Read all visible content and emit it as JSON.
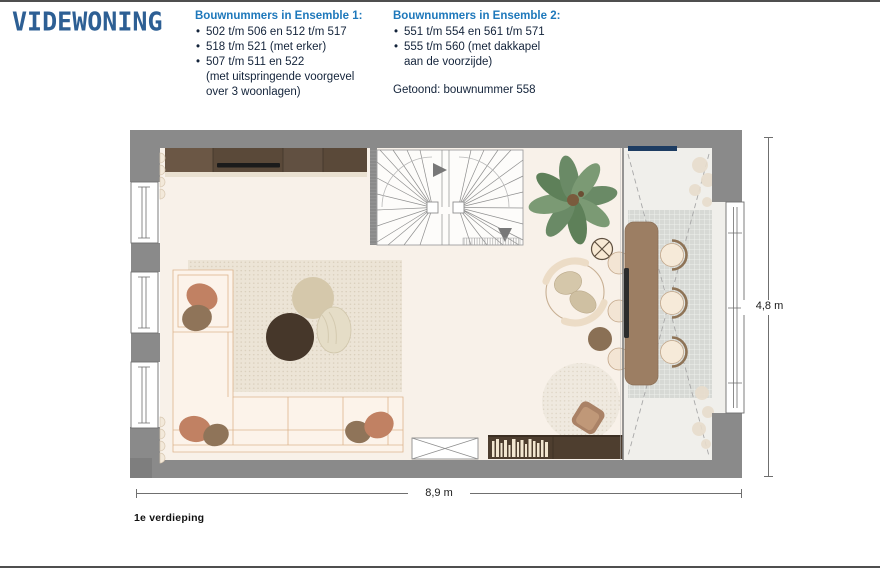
{
  "brand": {
    "logo_text": "VIDEWONING"
  },
  "header": {
    "ensemble1": {
      "title": "Bouwnummers in Ensemble 1:",
      "items": [
        "502 t/m 506 en 512 t/m 517",
        "518 t/m 521 (met erker)",
        "507 t/m 511 en 522\n(met uitspringende voorgevel\nover 3 woonlagen)"
      ]
    },
    "ensemble2": {
      "title": "Bouwnummers in Ensemble 2:",
      "items": [
        "551 t/m 554 en 561 t/m 571",
        "555 t/m 560 (met dakkapel\naan de voorzijde)"
      ],
      "shown_note": "Getoond: bouwnummer 558"
    }
  },
  "floorplan": {
    "floor_label": "1e verdieping",
    "dimensions": {
      "width_label": "8,9 m",
      "height_label": "4,8 m"
    },
    "depicted_elements": [
      "exterior-walls",
      "left-facade-windows",
      "right-facade-window",
      "winder-staircase",
      "wardrobe-cabinets",
      "corner-sofa",
      "area-rug",
      "poufs",
      "potted-plant",
      "pendant-light-symbol",
      "lounge-chair",
      "side-tables",
      "radiator",
      "bookshelf-cabinet",
      "reading-armchair",
      "round-rug",
      "void-with-dashed-lines",
      "dining-table",
      "dining-chairs",
      "railing",
      "checkered-rug"
    ],
    "colors": {
      "logo_blue": "#2d5f94",
      "heading_blue": "#1e78bb",
      "body_text": "#13233a",
      "wall_gray": "#8a8a8a",
      "floor_main": "#f8f1e9",
      "floor_void": "#f0efeb",
      "wood_brown": "#9c7e63",
      "cabinet_dark": "#4e3e2f",
      "plant_green": "#6f8e6b",
      "sofa_cream": "#fcf3ea",
      "terracotta": "#c18163",
      "navy_marker": "#1d3c62"
    }
  }
}
